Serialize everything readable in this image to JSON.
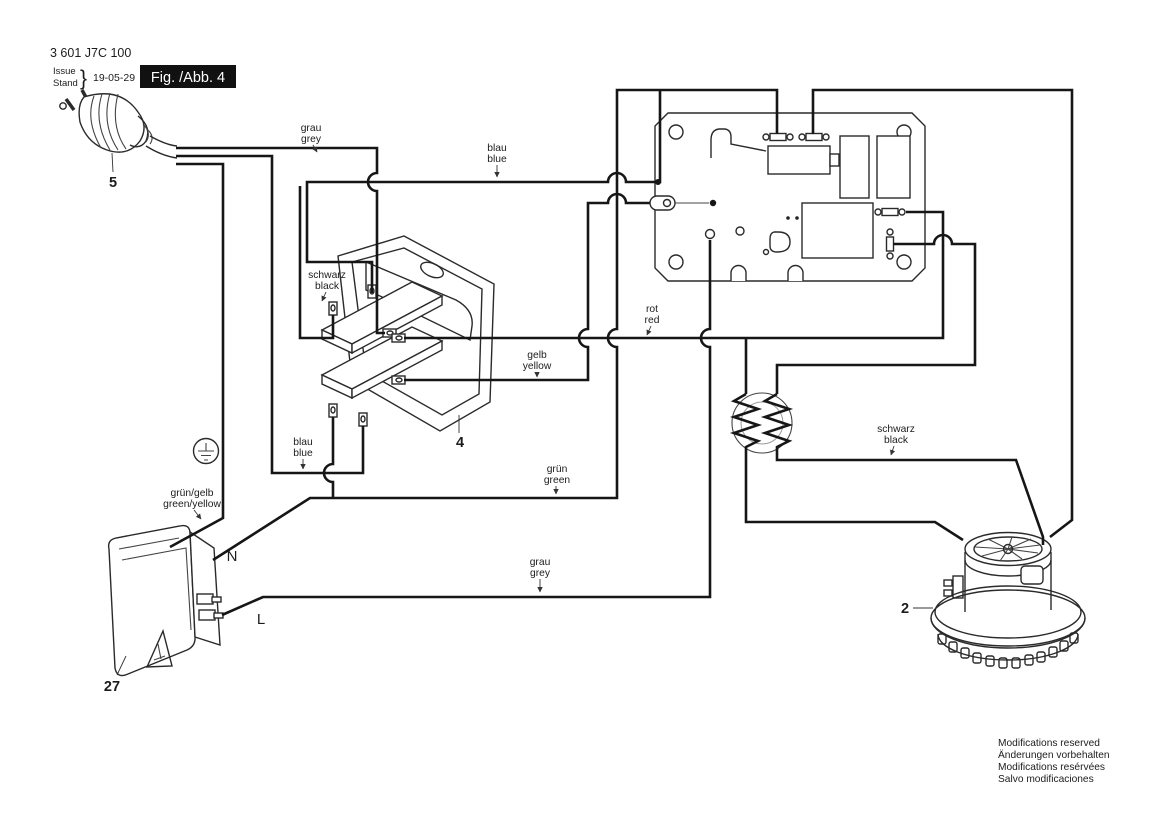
{
  "header": {
    "part_number": "3 601 J7C 100",
    "issue_label": "Issue",
    "stand_label": "Stand",
    "brace": "}",
    "date": "19-05-29",
    "figure_label": "Fig. /Abb. 4"
  },
  "wire_labels": {
    "grau_top": {
      "de": "grau",
      "en": "grey"
    },
    "blau_top": {
      "de": "blau",
      "en": "blue"
    },
    "schwarz_switch": {
      "de": "schwarz",
      "en": "black"
    },
    "gelb": {
      "de": "gelb",
      "en": "yellow"
    },
    "rot": {
      "de": "rot",
      "en": "red"
    },
    "blau_mid": {
      "de": "blau",
      "en": "blue"
    },
    "gruen": {
      "de": "grün",
      "en": "green"
    },
    "gruen_gelb": {
      "de": "grün/gelb",
      "en": "green/yellow"
    },
    "schwarz_right": {
      "de": "schwarz",
      "en": "black"
    },
    "grau_bottom": {
      "de": "grau",
      "en": "grey"
    }
  },
  "terminals": {
    "neutral": "N",
    "line": "L"
  },
  "components": {
    "plug_ref": "5",
    "switch_ref": "4",
    "motor_ref": "2",
    "socket_ref": "27"
  },
  "footer": {
    "lines": [
      "Modifications reserved",
      "Änderungen vorbehalten",
      "Modifications resérvées",
      "Salvo modificaciones"
    ]
  },
  "colors": {
    "ink": "#161616",
    "background": "#ffffff"
  }
}
